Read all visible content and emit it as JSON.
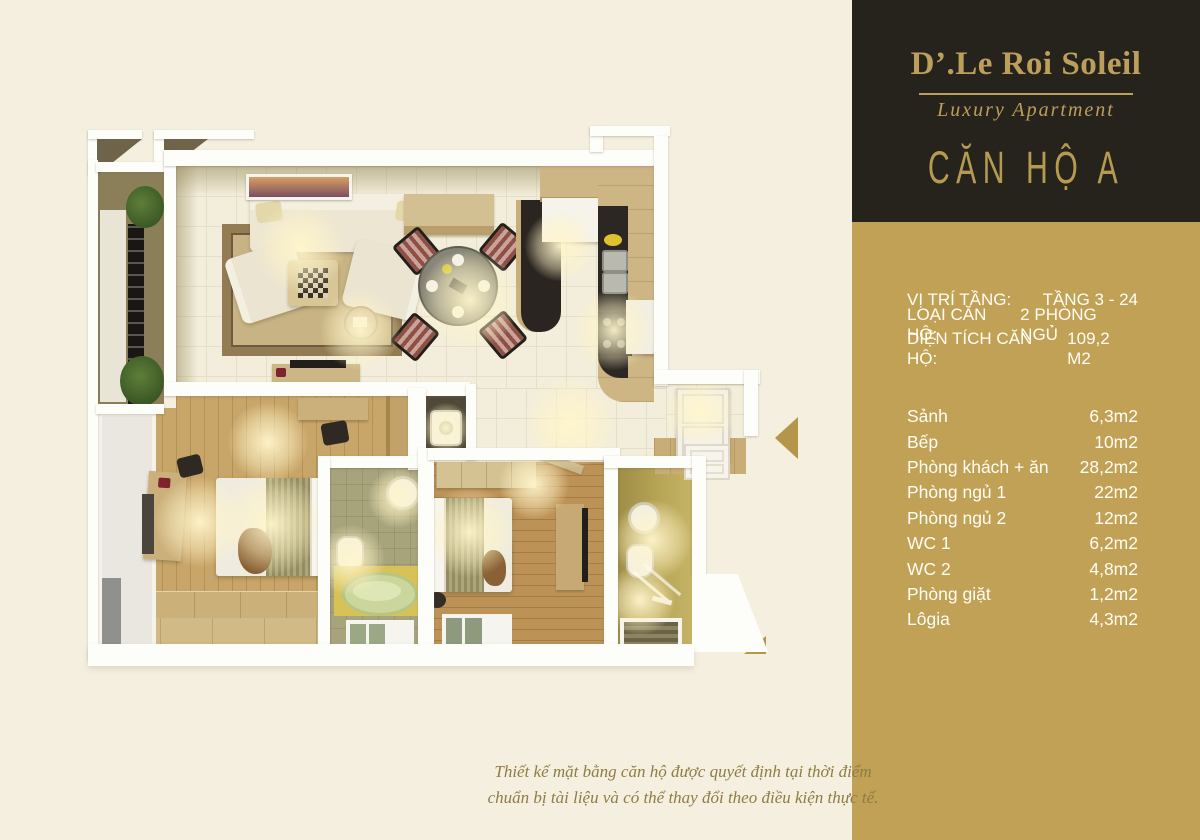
{
  "palette": {
    "background": "#f5efdf",
    "panel_dark": "#26231d",
    "panel_gold": "#c0a156",
    "gold_text": "#bd9f5c",
    "arrow": "#b4954a",
    "footnote_text": "#8e7c44"
  },
  "brand": {
    "title": "D’.Le Roi Soleil",
    "subtitle": "Luxury Apartment",
    "unit_name": "CĂN HỘ A"
  },
  "info": {
    "details": [
      {
        "label": "VỊ TRÍ TẦNG:",
        "value": "TẦNG 3 - 24"
      },
      {
        "label": "LOẠI CĂN HỘ:",
        "value": "2 PHÒNG NGỦ"
      },
      {
        "label": "DIỆN TÍCH CĂN HỘ:",
        "value": "109,2 M2"
      }
    ],
    "rooms": [
      {
        "label": "Sảnh",
        "value": "6,3m2"
      },
      {
        "label": "Bếp",
        "value": "10m2"
      },
      {
        "label": "Phòng khách + ăn",
        "value": "28,2m2"
      },
      {
        "label": "Phòng ngủ 1",
        "value": "22m2"
      },
      {
        "label": "Phòng ngủ 2",
        "value": "12m2"
      },
      {
        "label": "WC 1",
        "value": "6,2m2"
      },
      {
        "label": "WC 2",
        "value": "4,8m2"
      },
      {
        "label": "Phòng giặt",
        "value": "1,2m2"
      },
      {
        "label": "Lôgia",
        "value": "4,3m2"
      }
    ]
  },
  "footnote": {
    "line1": "Thiết kế mặt bằng căn hộ được quyết định tại thời điểm",
    "line2": "chuẩn bị tài liệu và có thể thay đổi theo điều kiện thực tế."
  }
}
